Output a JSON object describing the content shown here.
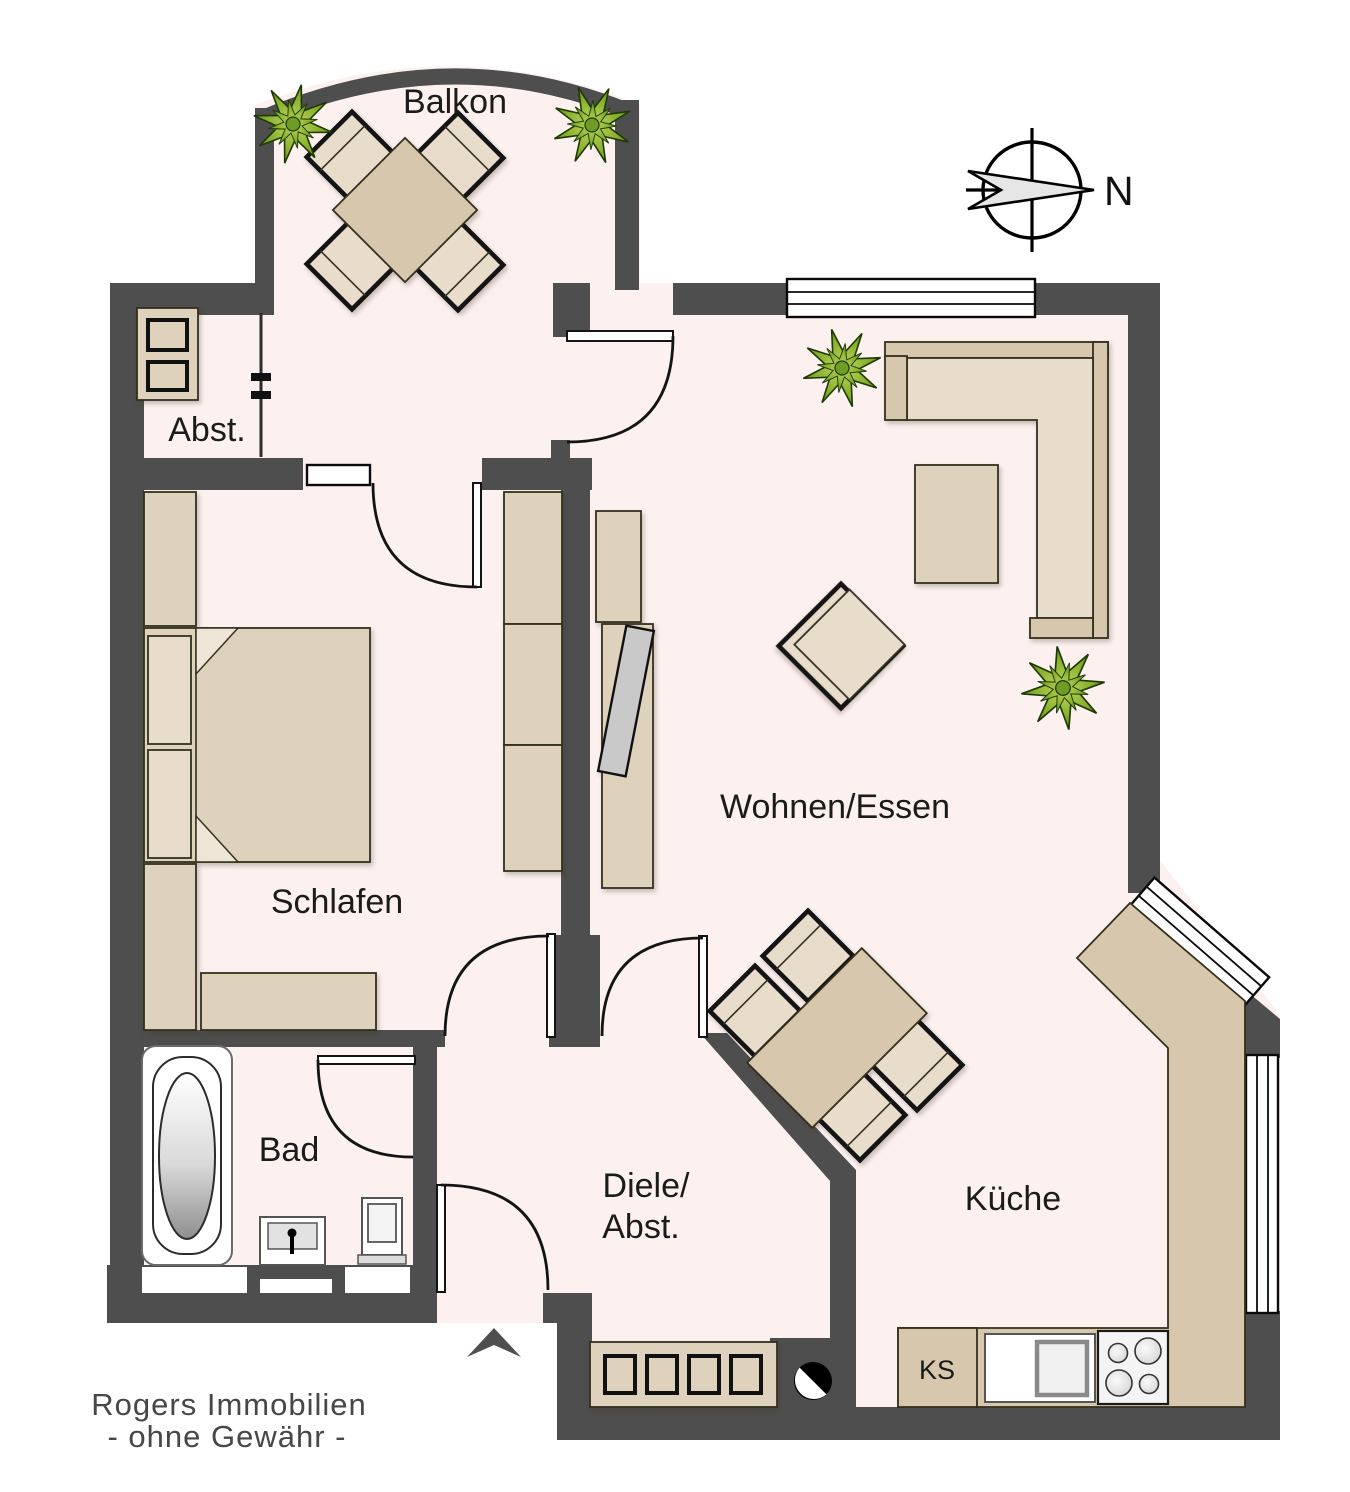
{
  "plan": {
    "rooms": {
      "balkon": "Balkon",
      "abstellraum": "Abst.",
      "schlafen": "Schlafen",
      "wohnen_essen": "Wohnen/Essen",
      "bad": "Bad",
      "diele_line1": "Diele/",
      "diele_line2": "Abst.",
      "kueche": "Küche"
    },
    "kitchen": {
      "fridge_label": "KS"
    },
    "compass": {
      "north_label": "N"
    },
    "footer": {
      "line1": "Rogers Immobilien",
      "line2": "- ohne Gewähr -"
    },
    "colors": {
      "wall": "#4e4e4e",
      "floor": "#fcf1ef",
      "furniture_light": "#e8dccb",
      "furniture_mid": "#dfd2bc",
      "furniture_dark": "#d7c7ac",
      "outline": "#141414",
      "plant_green_light": "#a9c944",
      "plant_green_dark": "#44700e",
      "tv_gray": "#c9c9c9",
      "text": "#1b1b1b",
      "footer_text": "#474747"
    }
  }
}
